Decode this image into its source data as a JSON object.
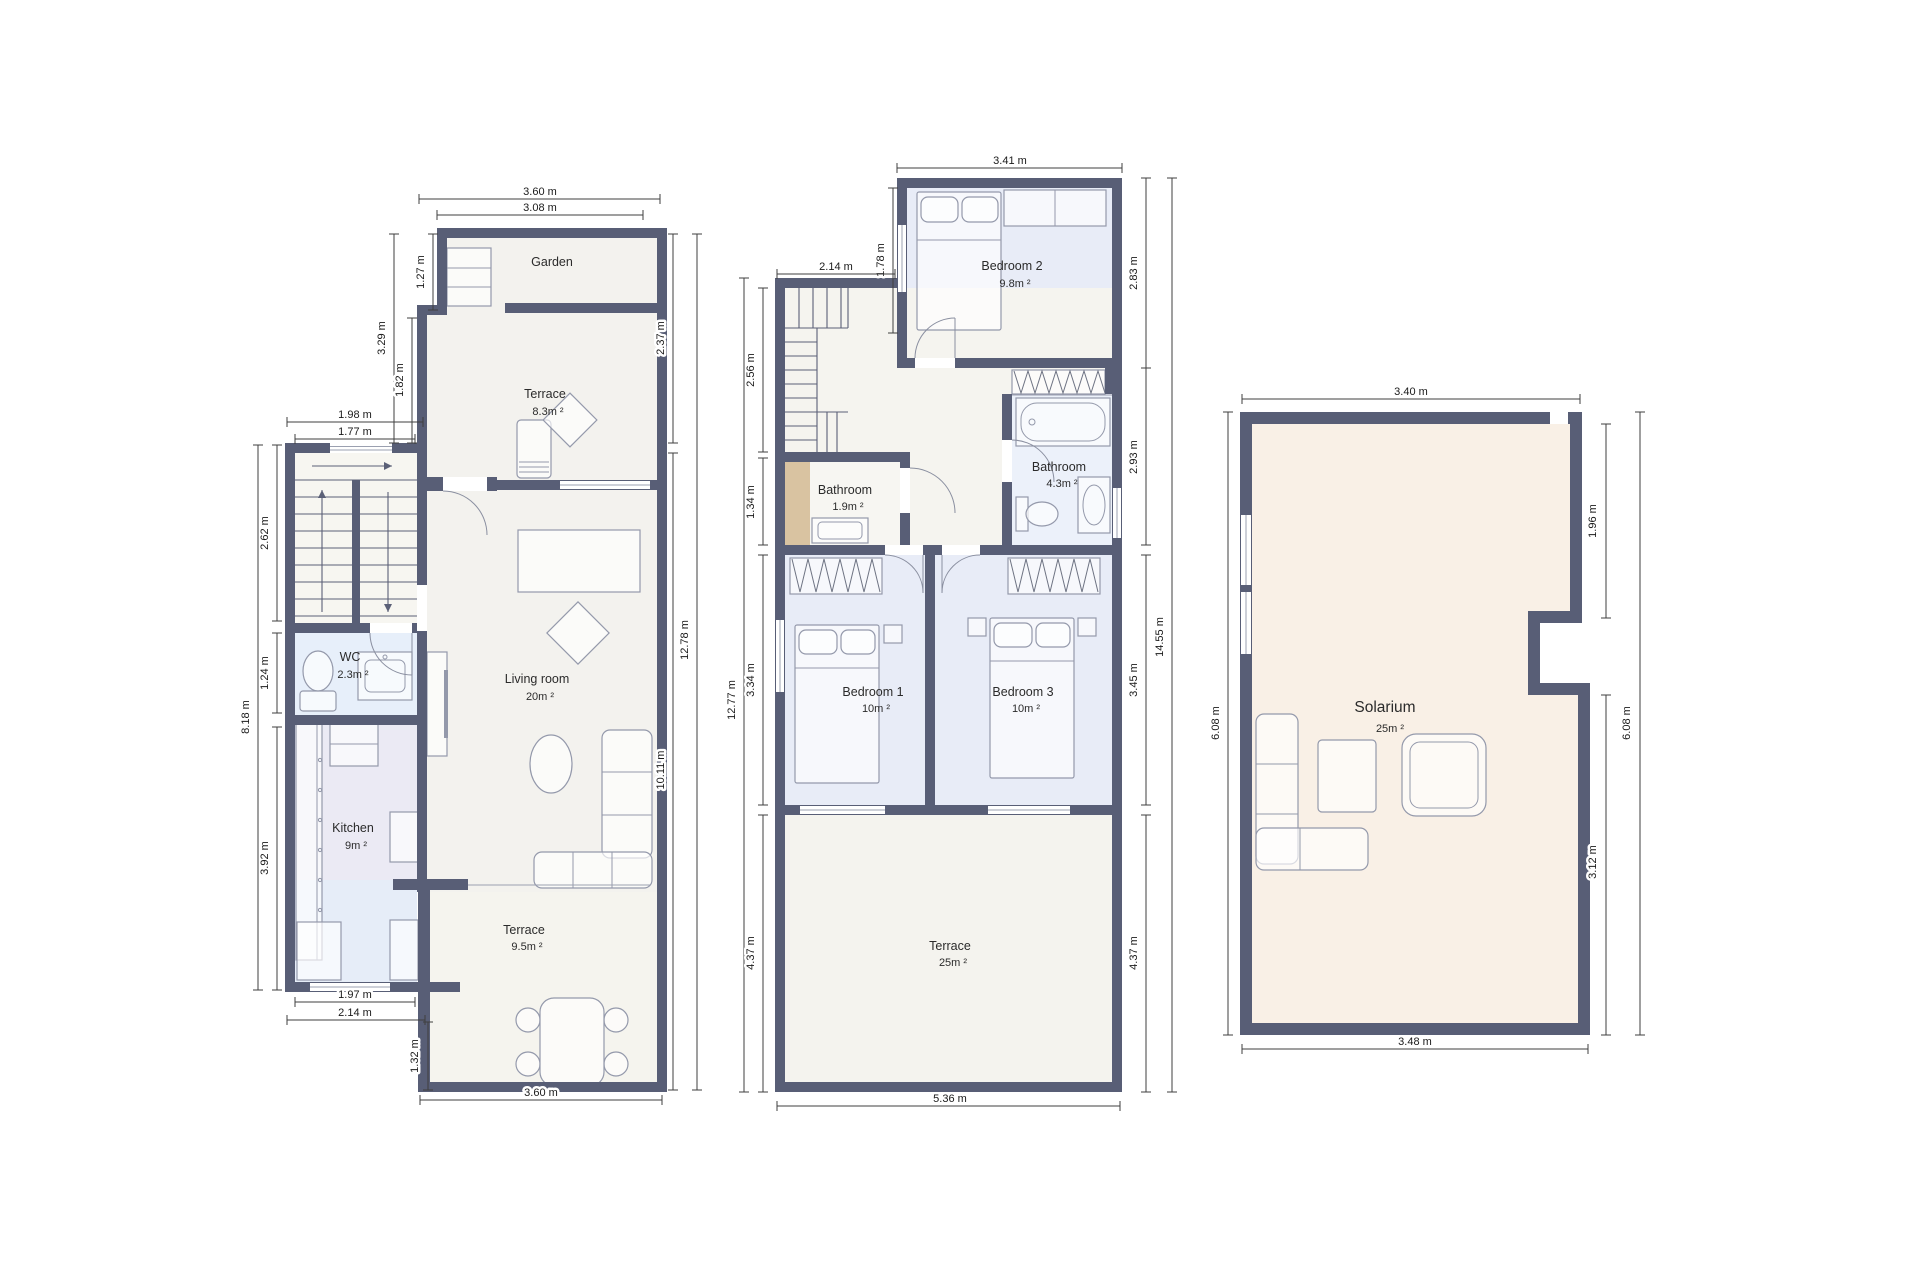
{
  "document": {
    "type": "floor-plan-set",
    "floor_count": 3
  },
  "colors": {
    "wall": "#585e76",
    "dim_line": "#3f3f3f",
    "text": "#2b2b2b",
    "common_floor": "#f3f2ee",
    "stair_floor": "#f7f6f1",
    "bedroom_floor": "#e8ecf7",
    "wc_floor": "#e7effa",
    "kitchen_upper": "#ebeaf4",
    "kitchen_lower": "#e6edf8",
    "bathroom_floor": "#ecf1fa",
    "solarium_floor": "#f9f0e6",
    "closet_tan": "#d9c3a1"
  },
  "ground": {
    "rooms": {
      "garden": {
        "name": "Garden",
        "area": ""
      },
      "terrace_top": {
        "name": "Terrace",
        "area": "8.3m ²"
      },
      "wc": {
        "name": "WC",
        "area": "2.3m ²"
      },
      "living": {
        "name": "Living room",
        "area": "20m ²"
      },
      "kitchen": {
        "name": "Kitchen",
        "area": "9m ²"
      },
      "terrace_bottom": {
        "name": "Terrace",
        "area": "9.5m ²"
      }
    },
    "dims": [
      "3.60 m",
      "3.08 m",
      "1.27 m",
      "3.29 m",
      "1.82 m",
      "1.98 m",
      "1.77 m",
      "2.62 m",
      "1.24 m",
      "3.92 m",
      "8.18 m",
      "1.97 m",
      "2.14 m",
      "1.32 m",
      "3.60 m",
      "2.37 m",
      "10.11 m",
      "12.78 m"
    ]
  },
  "first": {
    "rooms": {
      "bedroom2": {
        "name": "Bedroom 2",
        "area": "9.8m ²"
      },
      "bathroom_small": {
        "name": "Bathroom",
        "area": "1.9m ²"
      },
      "bathroom": {
        "name": "Bathroom",
        "area": "4.3m ²"
      },
      "bedroom1": {
        "name": "Bedroom 1",
        "area": "10m ²"
      },
      "bedroom3": {
        "name": "Bedroom 3",
        "area": "10m ²"
      },
      "terrace": {
        "name": "Terrace",
        "area": "25m ²"
      }
    },
    "dims": [
      "3.41 m",
      "1.78 m",
      "2.14 m",
      "2.56 m",
      "1.34 m",
      "12.77 m",
      "2.83 m",
      "2.93 m",
      "3.34 m",
      "3.45 m",
      "4.37 m",
      "4.37 m",
      "14.55 m",
      "5.36 m"
    ]
  },
  "solarium": {
    "rooms": {
      "solarium": {
        "name": "Solarium",
        "area": "25m ²"
      }
    },
    "dims": [
      "3.40 m",
      "1.96 m",
      "6.08 m",
      "3.12 m",
      "6.08 m",
      "3.48 m"
    ]
  }
}
